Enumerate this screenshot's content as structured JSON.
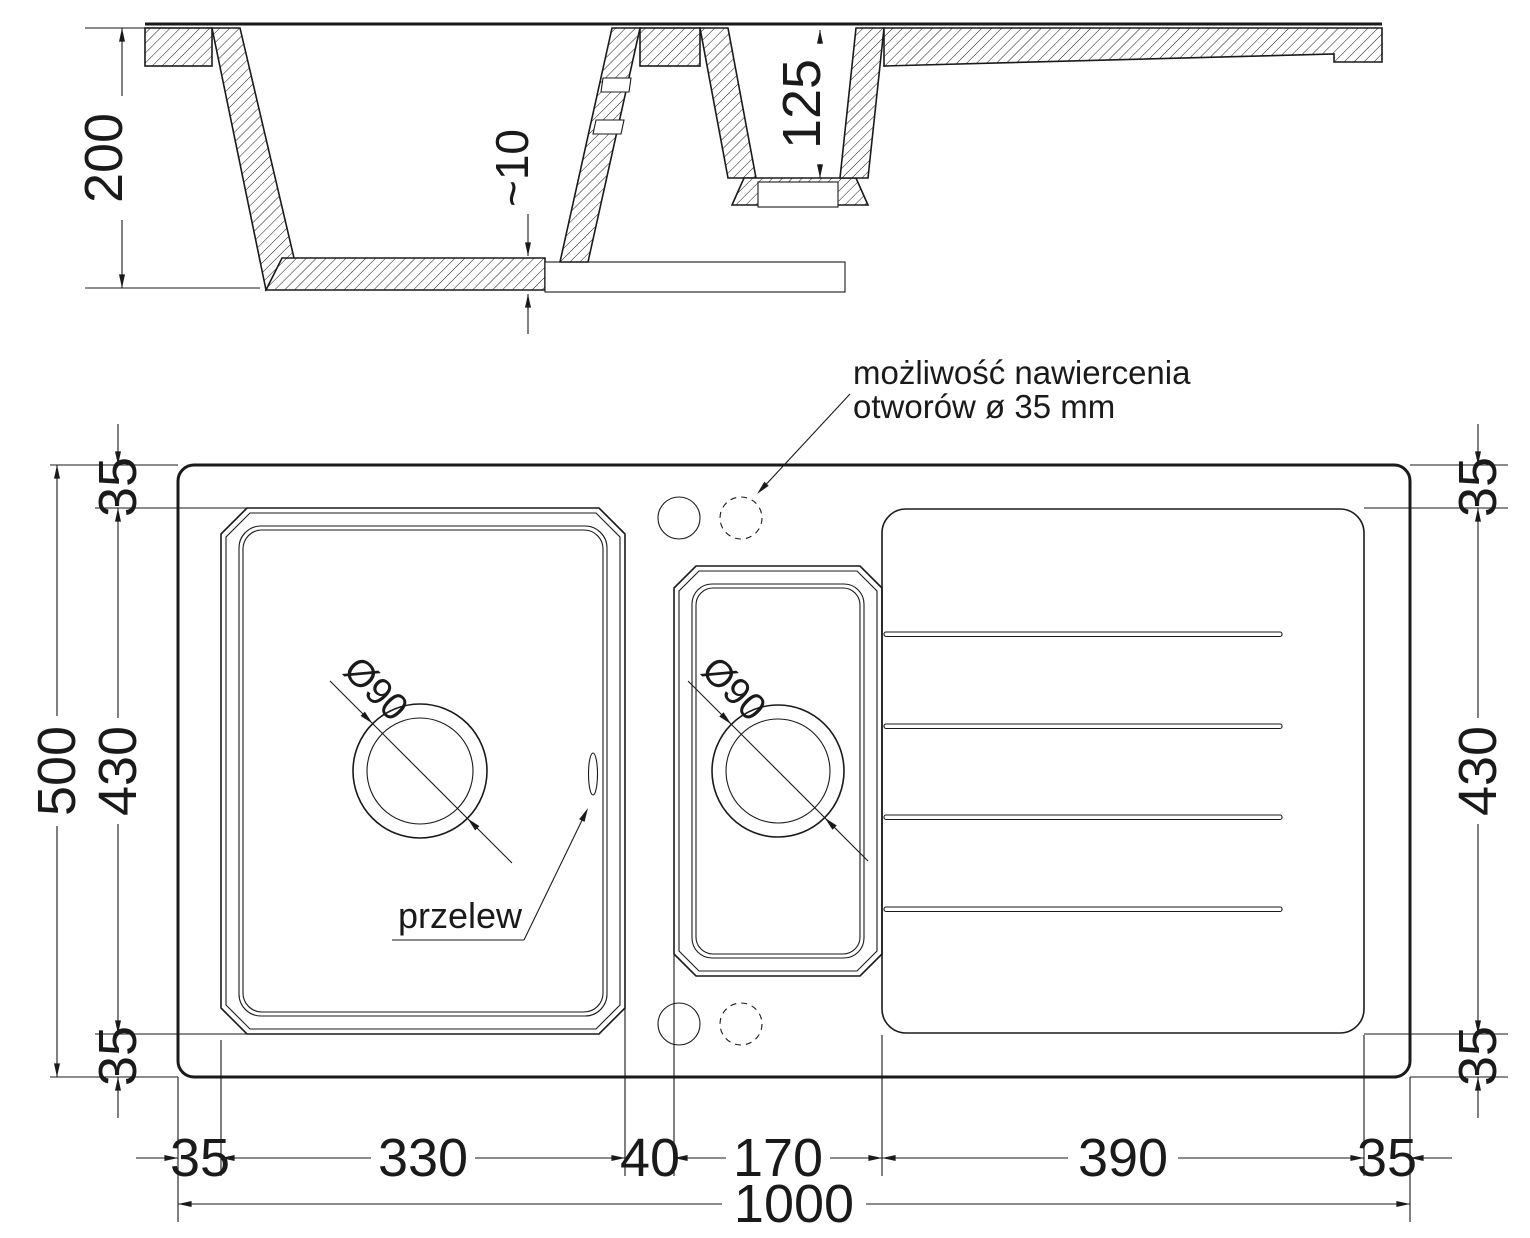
{
  "title": "sink technical drawing",
  "section": {
    "total_depth": "200",
    "bottom_thickness": "~10",
    "small_bowl_depth": "125"
  },
  "plan": {
    "note": {
      "line1": "możliwość nawiercenia",
      "line2": "otworów ø 35 mm"
    },
    "overflow_label": "przelew",
    "main_bowl": {
      "drain": "Ø90"
    },
    "small_bowl": {
      "drain": "Ø90"
    },
    "dims": {
      "left_total": "500",
      "left_top": "35",
      "left_mid": "430",
      "left_bottom": "35",
      "right_top": "35",
      "right_mid": "430",
      "right_bottom": "35",
      "bottom_margin_left": "35",
      "bottom_main": "330",
      "bottom_gap": "40",
      "bottom_small": "170",
      "bottom_drainer": "390",
      "bottom_margin_right": "35",
      "bottom_total": "1000"
    }
  },
  "colors": {
    "line": "#1a1a1a",
    "background": "#ffffff"
  }
}
